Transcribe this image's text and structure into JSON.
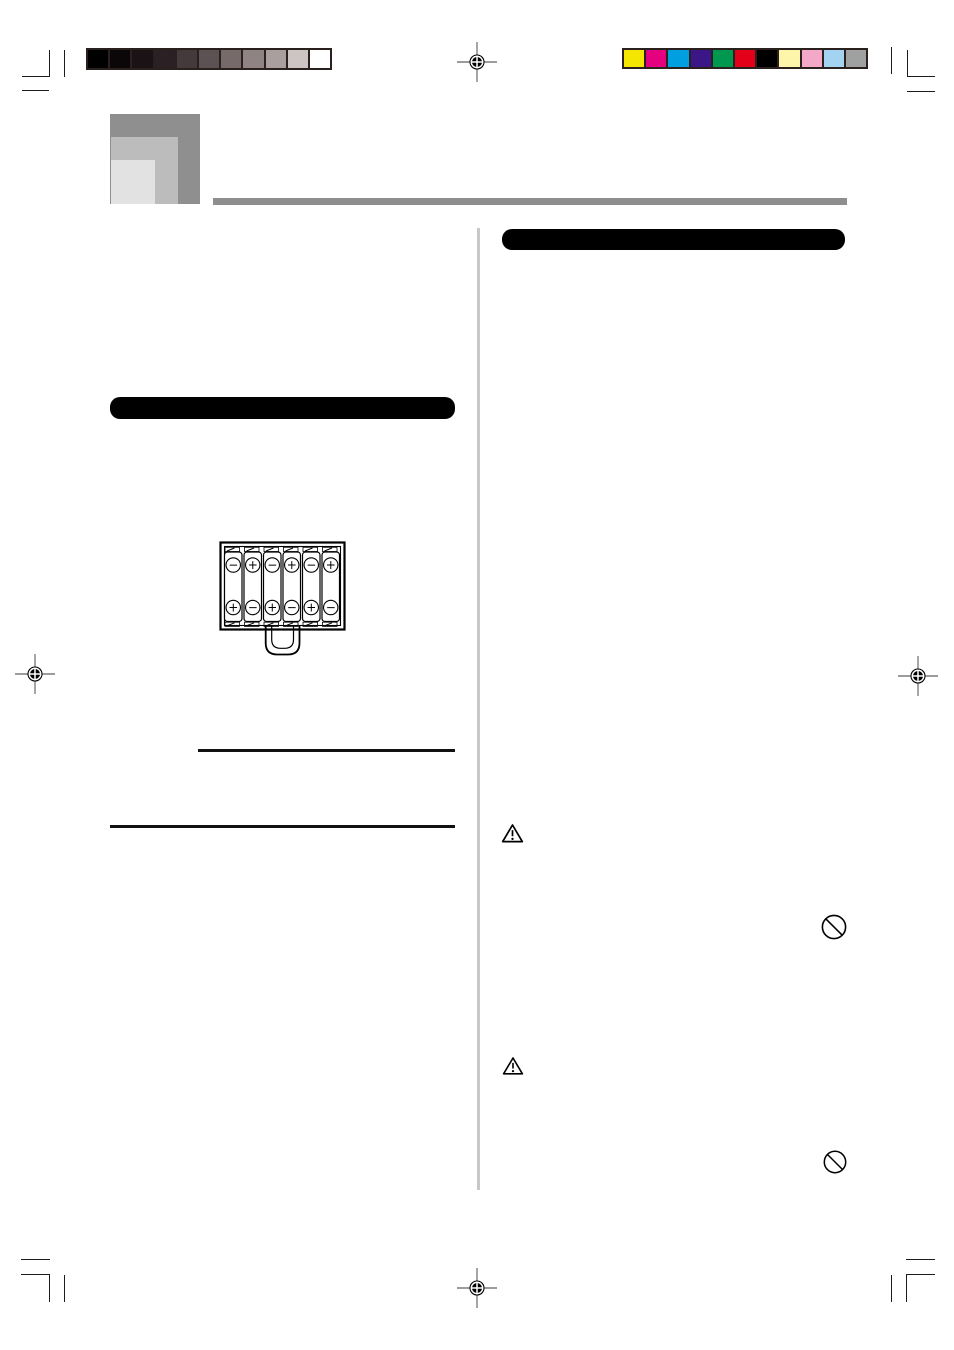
{
  "document": {
    "kind": "scanned manual proof page",
    "background": "#ffffff"
  },
  "calibration": {
    "grayscale_bar": [
      "#000000",
      "#0b0709",
      "#1a1214",
      "#2b2124",
      "#443a3c",
      "#5d5253",
      "#766a6b",
      "#8f8384",
      "#a99f9e",
      "#cdc5c3",
      "#ffffff"
    ],
    "color_bar": [
      "#f4e600",
      "#e4007f",
      "#00a0e0",
      "#3b1687",
      "#00984e",
      "#e50019",
      "#000000",
      "#fdf5aa",
      "#f3a8c8",
      "#a3d3f0",
      "#9fa0a0"
    ]
  },
  "header": {
    "logo_squares": [
      "#8f8f8f",
      "#bcbcbc",
      "#e2e2e2"
    ],
    "rule_color": "#8e8e8e"
  },
  "left_column": {
    "section_bar_color": "#000000",
    "battery_diagram": {
      "batteries": [
        {
          "top": "−",
          "bottom": "+"
        },
        {
          "top": "+",
          "bottom": "−"
        },
        {
          "top": "−",
          "bottom": "+"
        },
        {
          "top": "+",
          "bottom": "−"
        },
        {
          "top": "−",
          "bottom": "+"
        },
        {
          "top": "+",
          "bottom": "−"
        }
      ]
    }
  },
  "right_column": {
    "section_bar_color": "#000000"
  },
  "divider_color": "#c8c8c8"
}
